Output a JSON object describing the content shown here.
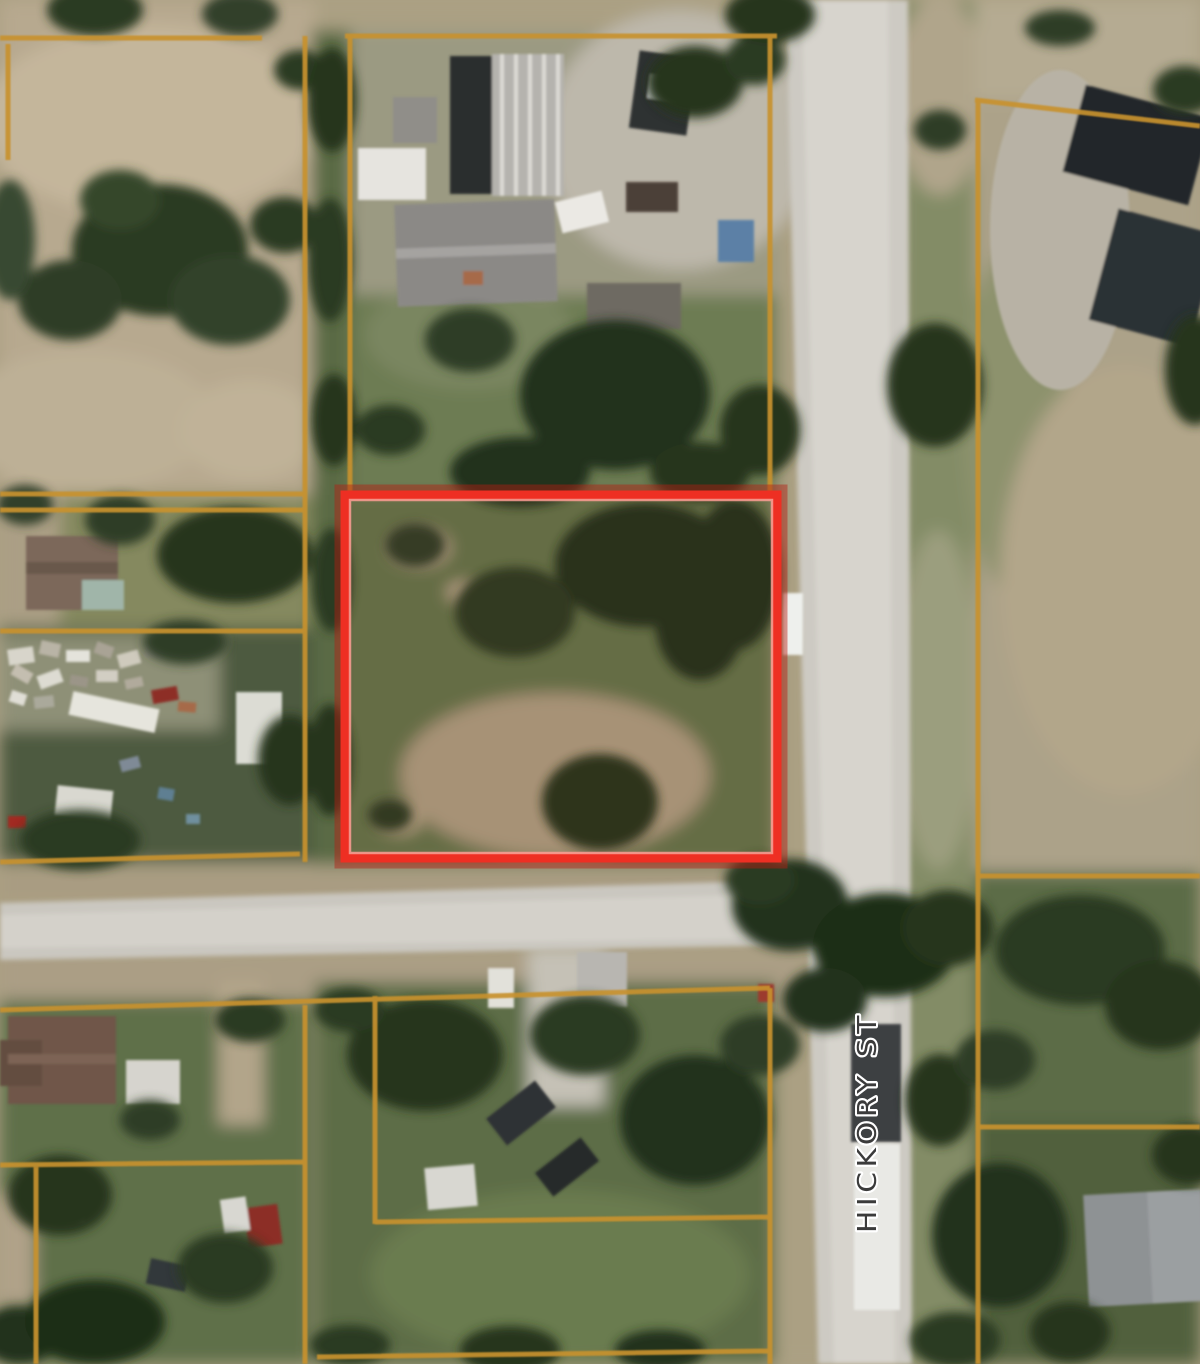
{
  "map": {
    "type": "satellite-parcel-view",
    "street_label": "HICKORY ST",
    "highlight_parcel": {
      "x": 345,
      "y": 495,
      "width": 432,
      "height": 363
    },
    "colors": {
      "parcel_line": "#c8922f",
      "highlight_outer": "#b61d12",
      "highlight_main": "#ee2f23",
      "highlight_inner": "#ff9d94",
      "label_text": "#3b3b3b",
      "label_halo": "#ffffff"
    }
  }
}
